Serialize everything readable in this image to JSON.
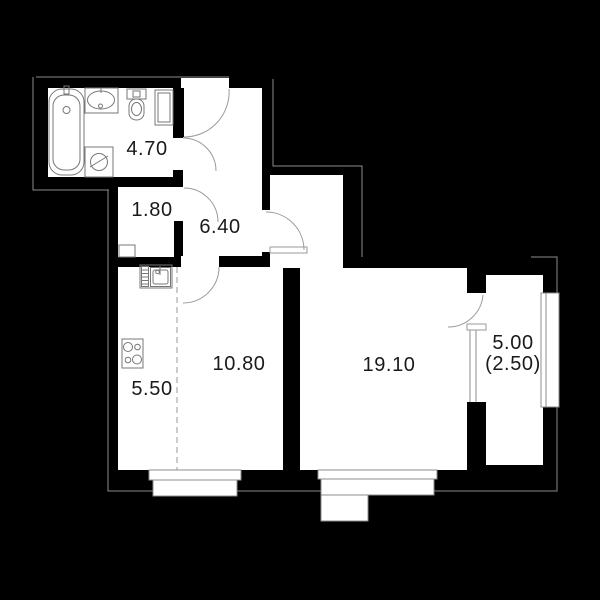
{
  "plan": {
    "type": "apartment-floor-plan",
    "background_color": "#000000",
    "wall_color": "#000000",
    "room_fill_color": "#ffffff",
    "outline_color": "#8c8c8c",
    "fixture_line_color": "#777777",
    "text_color": "#1a1a1a"
  },
  "rooms": [
    {
      "id": "bathroom",
      "area_label": "4.70"
    },
    {
      "id": "wardrobe",
      "area_label": "1.80"
    },
    {
      "id": "hallway",
      "area_label": "6.40"
    },
    {
      "id": "kitchen",
      "area_label": "5.50"
    },
    {
      "id": "living-room",
      "area_label": "10.80"
    },
    {
      "id": "bedroom",
      "area_label": "19.10"
    },
    {
      "id": "balcony",
      "area_label": "5.00",
      "area_label_secondary": "(2.50)"
    }
  ],
  "fixtures": [
    "bathtub",
    "bathroom-sink",
    "toilet",
    "duct-cabinet",
    "washing-machine",
    "kitchen-sink",
    "stove",
    "wardrobe-niche"
  ],
  "features": [
    "entrance-door",
    "bathroom-door",
    "wardrobe-door",
    "living-room-door",
    "bedroom-door",
    "balcony-door",
    "balcony-window",
    "kitchen-bay-window",
    "bedroom-bay-window",
    "balcony-glazing",
    "zoning-dashed-line"
  ]
}
